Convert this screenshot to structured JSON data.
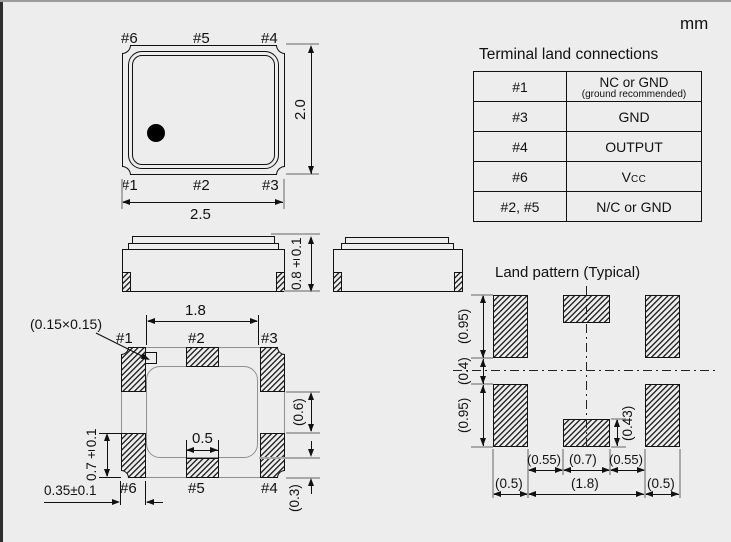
{
  "unit_label": "mm",
  "top_view": {
    "pins_top": [
      "#6",
      "#5",
      "#4"
    ],
    "pins_bottom": [
      "#1",
      "#2",
      "#3"
    ],
    "width_dim": "2.5",
    "height_dim": "2.0"
  },
  "side_view": {
    "height_dim": "0.8±0.1"
  },
  "bottom_view": {
    "pins_top": [
      "#1",
      "#2",
      "#3"
    ],
    "pins_bottom": [
      "#6",
      "#5",
      "#4"
    ],
    "index_notch_dim": "(0.15×0.15)",
    "inner_span_dim": "1.8",
    "corner_pad_height_dim": "0.7±0.1",
    "corner_pad_width_dim": "0.35±0.1",
    "center_pad_width_dim": "0.5",
    "side_gap_dim": "(0.6)",
    "edge_gap_dim": "(0.3)"
  },
  "land_pattern": {
    "title": "Land pattern (Typical)",
    "pad_height_top_dim": "(0.95)",
    "row_gap_dim": "(0.4)",
    "pad_height_bottom_dim": "(0.95)",
    "center_pad_height_dim": "(0.43)",
    "gap_left_dim": "(0.55)",
    "center_pad_width_dim": "(0.7)",
    "gap_right_dim": "(0.55)",
    "pad_width_left_dim": "(0.5)",
    "span_dim": "(1.8)",
    "pad_width_right_dim": "(0.5)"
  },
  "table": {
    "title": "Terminal land connections",
    "rows": [
      {
        "pin": "#1",
        "signal": "NC or GND",
        "note": "(ground recommended)"
      },
      {
        "pin": "#3",
        "signal": "GND",
        "note": ""
      },
      {
        "pin": "#4",
        "signal": "OUTPUT",
        "note": ""
      },
      {
        "pin": "#6",
        "signal": "V",
        "signal_sub": "CC",
        "note": ""
      },
      {
        "pin": "#2, #5",
        "signal": "N/C or GND",
        "note": ""
      }
    ]
  }
}
